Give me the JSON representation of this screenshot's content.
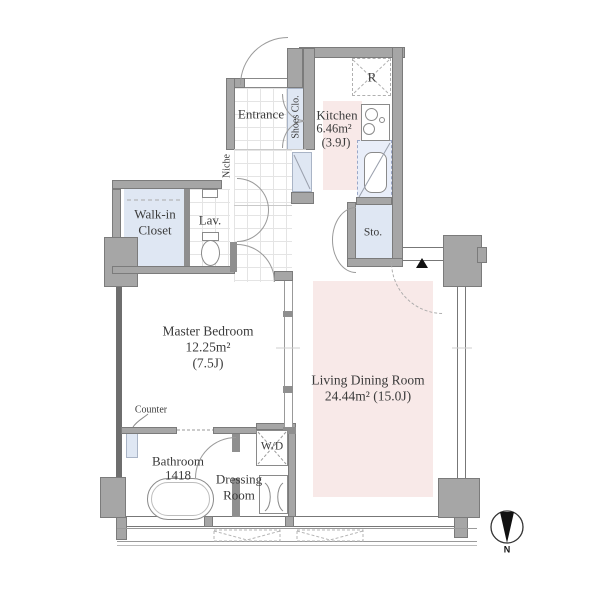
{
  "rooms": {
    "entrance": {
      "name": "Entrance"
    },
    "shoes_closet": {
      "name": "Shoes Clo."
    },
    "niche": {
      "name": "Niche"
    },
    "kitchen": {
      "name": "Kitchen",
      "area_m2": "6.46m²",
      "area_jo": "(3.9J)"
    },
    "refrigerator": {
      "name": "R"
    },
    "storage": {
      "name": "Sto."
    },
    "walk_in_closet": {
      "name_line1": "Walk-in",
      "name_line2": "Closet"
    },
    "lavatory": {
      "name": "Lav."
    },
    "master_bedroom": {
      "name": "Master Bedroom",
      "area_m2": "12.25m²",
      "area_jo": "(7.5J)"
    },
    "living_dining": {
      "name": "Living Dining Room",
      "area": "24.44m² (15.0J)"
    },
    "bathroom": {
      "name": "Bathroom",
      "size_code": "1418"
    },
    "dressing_room": {
      "name_line1": "Dressing",
      "name_line2": "Room"
    },
    "washer_dryer": {
      "name": "W/D"
    },
    "counter": {
      "name": "Counter"
    }
  },
  "compass": {
    "north_label": "N"
  },
  "colors": {
    "wall": "#a6a6a6",
    "wall_border": "#7b7b7b",
    "closet_fill": "#dfe7f3",
    "accent_fill": "#f8e9e8",
    "line": "#8a8a8a",
    "text": "#3b3b3b"
  }
}
